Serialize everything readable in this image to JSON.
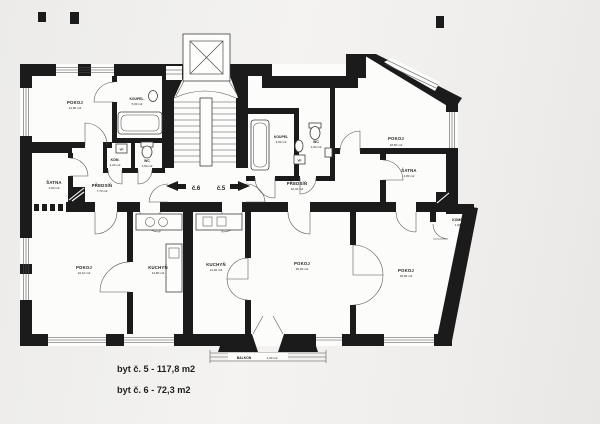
{
  "plan": {
    "colors": {
      "bg": "#f0eeec",
      "paper": "#fcfcfb",
      "wall": "#1b1b1b",
      "line": "#4e4e4e",
      "ink": "#1f1f1f"
    },
    "entrances": {
      "left_label": "č.6",
      "right_label": "č.5"
    },
    "rooms": [
      {
        "name": "POKOJ",
        "area": "14,80 m2"
      },
      {
        "name": "KOUPEL.",
        "area": "5,00 m2"
      },
      {
        "name": "KOM.",
        "area": "1,20 m2"
      },
      {
        "name": "WC",
        "area": "1,50 m2"
      },
      {
        "name": "ŠATNA",
        "area": "2,90 m2"
      },
      {
        "name": "PŘEDSÍŇ",
        "area": "7,70 m2"
      },
      {
        "name": "KOUPEL",
        "area": "3,60 m2"
      },
      {
        "name": "WC",
        "area": "1,60 m2"
      },
      {
        "name": "PŘEDSÍŇ",
        "area": "10,40 m2"
      },
      {
        "name": "POKOJ",
        "area": "18,80 m2"
      },
      {
        "name": "ŠATNA",
        "area": "4,80 m2"
      },
      {
        "name": "KOMORA",
        "area": "1,90 m2"
      },
      {
        "name": "POKOJ",
        "area": "22,10 m2"
      },
      {
        "name": "KUCHYŇ",
        "area": "14,80 m2"
      },
      {
        "name": "KUCHYŇ",
        "area": "14,00 m2"
      },
      {
        "name": "POKOJ",
        "area": "26,00 m2"
      },
      {
        "name": "POKOJ",
        "area": "26,80 m2"
      },
      {
        "name": "BALKON",
        "area": "2,30 m2"
      }
    ],
    "utility_labels": {
      "vr_left": "VR",
      "vr_right": "VR"
    },
    "footer": {
      "apartment_5": "byt č. 5 - 117,8 m2",
      "apartment_6": "byt č. 6 - 72,3 m2"
    }
  }
}
